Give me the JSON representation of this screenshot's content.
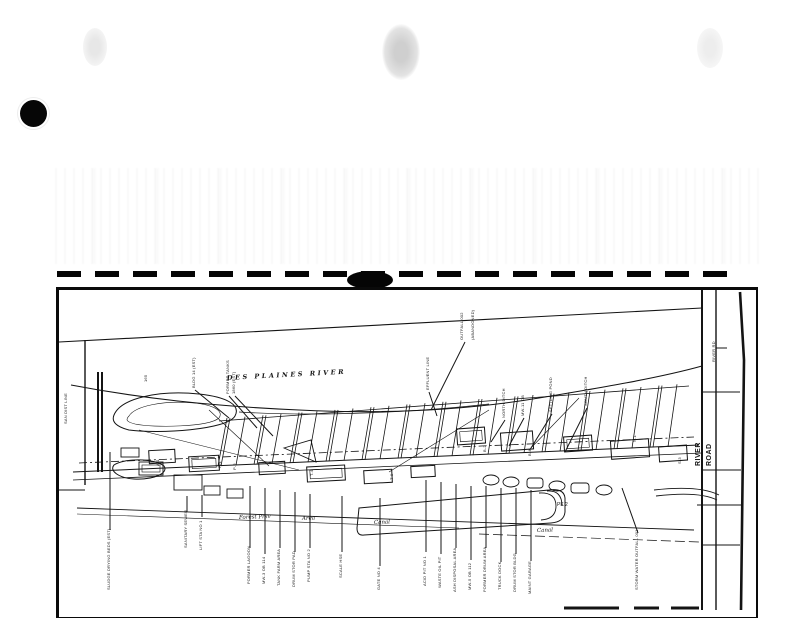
{
  "document": {
    "kind": "scanned site plan page",
    "colors": {
      "ink": "#101010",
      "paper": "#ffffff"
    }
  },
  "map": {
    "annotations": [
      {
        "name": "river-name-label",
        "text": "DES  PLAINES  RIVER",
        "x": 168,
        "y": 90,
        "rot": -3,
        "size": 6.5,
        "cls": "river",
        "ls": 2.5
      },
      {
        "name": "road-name-word-1",
        "text": "RIVER",
        "x": 641,
        "y": 176,
        "rot": -90,
        "cls": "roadbig"
      },
      {
        "name": "road-name-word-2",
        "text": "ROAD",
        "x": 652,
        "y": 176,
        "rot": -90,
        "cls": "roadbig"
      },
      {
        "name": "road-small-label",
        "text": "RIVER RD",
        "x": 656,
        "y": 72,
        "rot": -90,
        "cls": "lbl"
      },
      {
        "name": "boundary-label",
        "text": "SAN DIST LINE",
        "x": 8,
        "y": 134,
        "rot": -90,
        "cls": "lbl"
      },
      {
        "name": "map-label",
        "text": "165",
        "x": 88,
        "y": 92,
        "rot": -90,
        "cls": "lbl"
      },
      {
        "name": "map-label",
        "text": "BLDG 14 (EST)",
        "x": 136,
        "y": 98,
        "rot": -90,
        "cls": "lbl",
        "lead": [
          136,
          100,
          170,
          128
        ]
      },
      {
        "name": "map-label",
        "text": "FORMER TANKS",
        "x": 170,
        "y": 104,
        "rot": -90,
        "cls": "lbl",
        "lead": [
          170,
          106,
          198,
          138
        ]
      },
      {
        "name": "map-label",
        "text": "1860 (EST)",
        "x": 176,
        "y": 104,
        "rot": -90,
        "cls": "lbl",
        "lead": [
          176,
          106,
          214,
          146
        ]
      },
      {
        "name": "map-label",
        "text": "EFFLUENT LINE",
        "x": 370,
        "y": 100,
        "rot": -90,
        "cls": "lbl",
        "lead": [
          370,
          102,
          378,
          126
        ]
      },
      {
        "name": "map-label",
        "text": "OUTFALL 002",
        "x": 404,
        "y": 50,
        "rot": -90,
        "cls": "lbl",
        "lead": [
          406,
          52,
          372,
          120
        ]
      },
      {
        "name": "map-label",
        "text": "(ABANDONED)",
        "x": 415,
        "y": 50,
        "rot": -90,
        "cls": "lbl"
      },
      {
        "name": "map-label",
        "text": "NORTH DITCH",
        "x": 446,
        "y": 128,
        "rot": -90,
        "cls": "lbl",
        "lead": [
          446,
          130,
          432,
          152
        ]
      },
      {
        "name": "map-label",
        "text": "MW-11 OB",
        "x": 465,
        "y": 126,
        "rot": -90,
        "cls": "lbl",
        "lead": [
          465,
          128,
          450,
          156
        ]
      },
      {
        "name": "map-label",
        "text": "SETTLING POND",
        "x": 493,
        "y": 122,
        "rot": -90,
        "cls": "lbl",
        "lead": [
          493,
          124,
          472,
          158
        ]
      },
      {
        "name": "map-label",
        "text": "SOUTH DITCH",
        "x": 528,
        "y": 116,
        "rot": -90,
        "cls": "lbl",
        "lead": [
          528,
          118,
          506,
          162
        ]
      },
      {
        "name": "map-label",
        "text": "SLUDGE DRYING BEDS (EST)",
        "x": 51,
        "y": 300,
        "rot": -90,
        "cls": "lbl",
        "lead": [
          51,
          162,
          51,
          240
        ]
      },
      {
        "name": "map-label",
        "text": "SANITARY SEWER",
        "x": 128,
        "y": 258,
        "rot": -90,
        "cls": "lbl",
        "lead": [
          128,
          206,
          128,
          222
        ]
      },
      {
        "name": "map-label",
        "text": "LIFT STA NO 1",
        "x": 143,
        "y": 260,
        "rot": -90,
        "cls": "lbl",
        "lead": [
          143,
          205,
          143,
          227
        ]
      },
      {
        "name": "map-label",
        "text": "FORMER LAGOON",
        "x": 191,
        "y": 294,
        "rot": -90,
        "cls": "lbl",
        "lead": [
          191,
          196,
          191,
          258
        ]
      },
      {
        "name": "map-label",
        "text": "MW-3 OB 114",
        "x": 206,
        "y": 294,
        "rot": -90,
        "cls": "lbl",
        "lead": [
          206,
          198,
          206,
          264
        ]
      },
      {
        "name": "map-label",
        "text": "TANK FARM AREA",
        "x": 221,
        "y": 296,
        "rot": -90,
        "cls": "lbl",
        "lead": [
          221,
          200,
          221,
          258
        ]
      },
      {
        "name": "map-label",
        "text": "DRUM STOR PAD",
        "x": 236,
        "y": 297,
        "rot": -90,
        "cls": "lbl",
        "lead": [
          236,
          202,
          236,
          262
        ]
      },
      {
        "name": "map-label",
        "text": "PUMP STA NO 2",
        "x": 251,
        "y": 292,
        "rot": -90,
        "cls": "lbl",
        "lead": [
          251,
          204,
          251,
          258
        ]
      },
      {
        "name": "map-label",
        "text": "SCALE HSE",
        "x": 283,
        "y": 288,
        "rot": -90,
        "cls": "lbl",
        "lead": [
          283,
          206,
          283,
          262
        ]
      },
      {
        "name": "map-label",
        "text": "GATE NO 4",
        "x": 321,
        "y": 300,
        "rot": -90,
        "cls": "lbl",
        "lead": [
          321,
          208,
          321,
          276
        ]
      },
      {
        "name": "map-label",
        "text": "ACID PIT NO 1",
        "x": 367,
        "y": 296,
        "rot": -90,
        "cls": "lbl",
        "lead": [
          367,
          190,
          367,
          262
        ]
      },
      {
        "name": "map-label",
        "text": "WASTE OIL PIT",
        "x": 382,
        "y": 298,
        "rot": -90,
        "cls": "lbl",
        "lead": [
          382,
          192,
          382,
          264
        ]
      },
      {
        "name": "map-label",
        "text": "ASH DISPOSAL AREA",
        "x": 397,
        "y": 302,
        "rot": -90,
        "cls": "lbl",
        "lead": [
          397,
          194,
          397,
          258
        ]
      },
      {
        "name": "map-label",
        "text": "MW-5 OB 112",
        "x": 412,
        "y": 300,
        "rot": -90,
        "cls": "lbl",
        "lead": [
          412,
          196,
          412,
          270
        ]
      },
      {
        "name": "map-label",
        "text": "FORMER DRUM AREA",
        "x": 427,
        "y": 302,
        "rot": -90,
        "cls": "lbl",
        "lead": [
          427,
          196,
          427,
          258
        ]
      },
      {
        "name": "map-label",
        "text": "TRUCK DOCK",
        "x": 442,
        "y": 300,
        "rot": -90,
        "cls": "lbl",
        "lead": [
          442,
          198,
          442,
          272
        ]
      },
      {
        "name": "map-label",
        "text": "DRUM STOR BLDG",
        "x": 457,
        "y": 302,
        "rot": -90,
        "cls": "lbl",
        "lead": [
          457,
          198,
          457,
          264
        ]
      },
      {
        "name": "map-label",
        "text": "MAINT GARAGE",
        "x": 472,
        "y": 304,
        "rot": -90,
        "cls": "lbl",
        "lead": [
          472,
          200,
          472,
          271
        ]
      },
      {
        "name": "map-label",
        "text": "STORM WATER OUTFALL 001",
        "x": 579,
        "y": 300,
        "rot": -90,
        "cls": "lbl",
        "lead": [
          563,
          198,
          579,
          243
        ]
      },
      {
        "name": "parcel-label",
        "text": "P-1",
        "x": 162,
        "y": 178,
        "rot": -90,
        "cls": "lbl"
      },
      {
        "name": "parcel-label",
        "text": "P-2",
        "x": 177,
        "y": 180,
        "rot": -90,
        "cls": "lbl"
      },
      {
        "name": "parcel-label",
        "text": "T-4",
        "x": 254,
        "y": 186,
        "rot": -90,
        "cls": "lbl"
      },
      {
        "name": "parcel-label",
        "text": "T-9",
        "x": 334,
        "y": 190,
        "rot": -90,
        "cls": "lbl"
      },
      {
        "name": "parcel-label",
        "text": "B-2",
        "x": 427,
        "y": 162,
        "rot": -90,
        "cls": "lbl"
      },
      {
        "name": "parcel-label",
        "text": "B-4",
        "x": 472,
        "y": 166,
        "rot": -90,
        "cls": "lbl"
      },
      {
        "name": "parcel-label",
        "text": "N-1",
        "x": 577,
        "y": 152,
        "rot": -90,
        "cls": "lbl"
      },
      {
        "name": "parcel-label",
        "text": "S-3",
        "x": 622,
        "y": 174,
        "rot": -90,
        "cls": "lbl"
      },
      {
        "name": "parcel-label",
        "text": "A-1",
        "x": 100,
        "y": 176,
        "rot": -90,
        "cls": "lbl"
      },
      {
        "name": "parcel-label",
        "text": "PK 2",
        "x": 498,
        "y": 216,
        "rot": 0,
        "cls": "lbl5"
      },
      {
        "name": "cursive-note",
        "text": "Forest Prsv",
        "x": 180,
        "y": 229,
        "rot": -2,
        "cls": "cursive"
      },
      {
        "name": "cursive-note",
        "text": "Area",
        "x": 243,
        "y": 230,
        "rot": -2,
        "cls": "cursive"
      },
      {
        "name": "cursive-note",
        "text": "Canal",
        "x": 315,
        "y": 234,
        "rot": -2,
        "cls": "cursive"
      },
      {
        "name": "cursive-note",
        "text": "Canal",
        "x": 478,
        "y": 242,
        "rot": -2,
        "cls": "cursive"
      }
    ]
  }
}
